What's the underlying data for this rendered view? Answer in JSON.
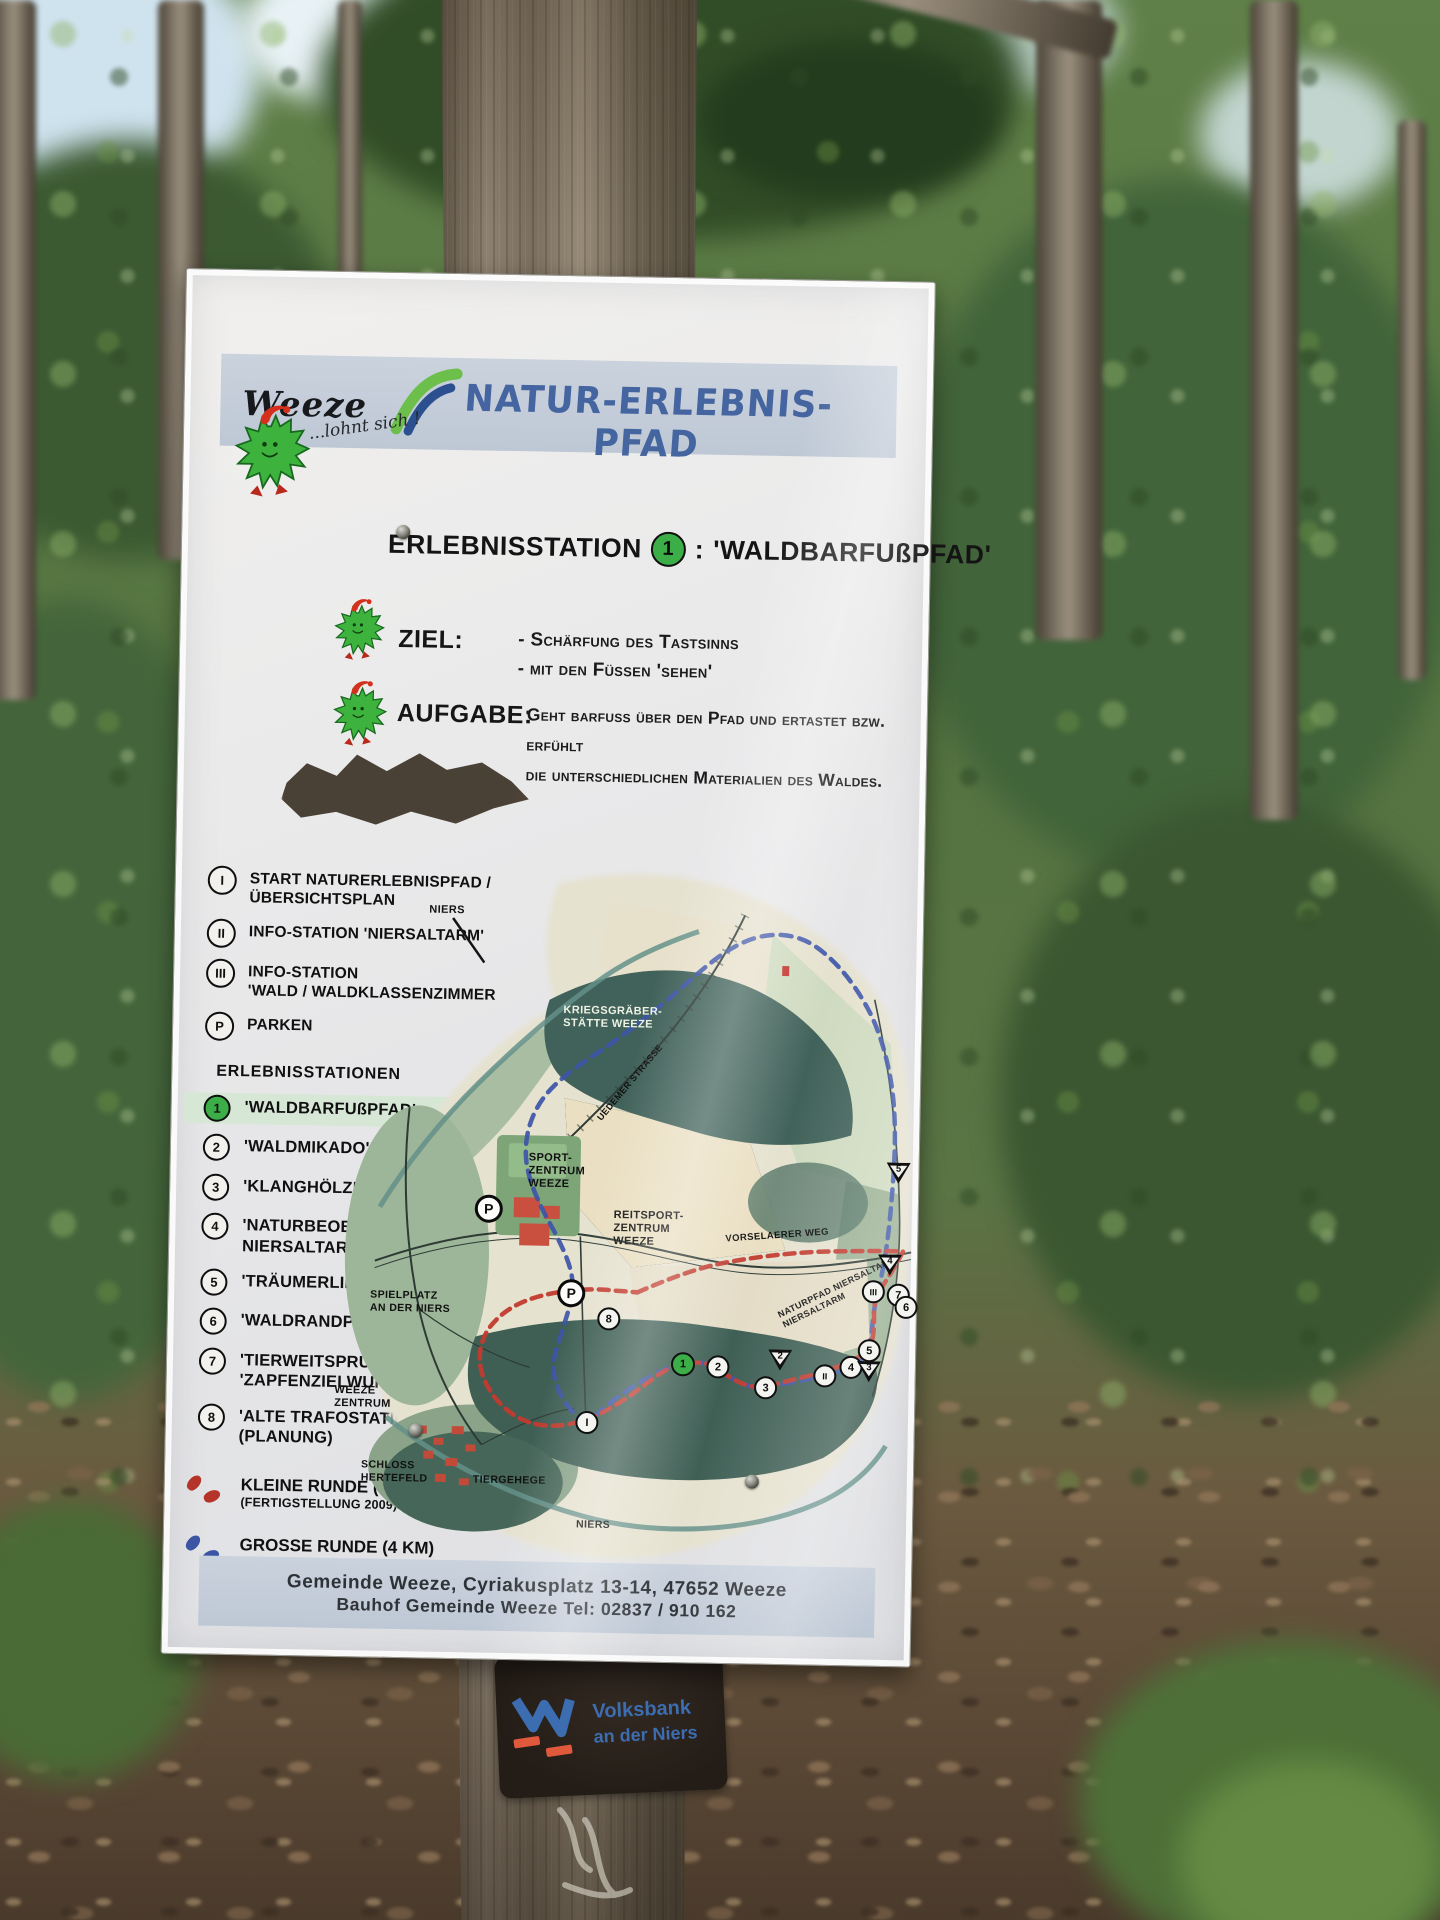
{
  "header": {
    "logo_text": "Weeze",
    "logo_tagline": "...lohnt sich !",
    "title": "NATUR-ERLEBNIS-PFAD"
  },
  "heading": {
    "prefix": "ERLEBNISSTATION",
    "number": "1",
    "separator": ":",
    "name": "'WALDBARFUßPFAD'"
  },
  "ziel": {
    "label": "ZIEL:",
    "lines_text": "- Schärfung des Tastsinns\n- mit den Füssen 'sehen'"
  },
  "aufgabe": {
    "label": "AUFGABE:",
    "lines_text": "Geht barfuss über den Pfad und ertastet bzw. erfühlt\ndie unterschiedlichen Materialien des Waldes."
  },
  "legend": {
    "items": [
      {
        "sym": "I",
        "lines": [
          "START NATURERLEBNISPFAD / ÜBERSICHTSPLAN"
        ]
      },
      {
        "sym": "II",
        "lines": [
          "INFO-STATION 'NIERSALTARM'"
        ]
      },
      {
        "sym": "III",
        "lines": [
          "INFO-STATION",
          "'WALD / WALDKLASSENZIMMER"
        ]
      },
      {
        "sym": "P",
        "lines": [
          "PARKEN"
        ]
      }
    ],
    "stations_title": "ERLEBNISSTATIONEN",
    "stations": [
      {
        "num": "1",
        "lines": [
          "'WALDBARFUßPFAD'"
        ],
        "highlight": true
      },
      {
        "num": "2",
        "lines": [
          "'WALDMIKADO'"
        ]
      },
      {
        "num": "3",
        "lines": [
          "'KLANGHÖLZER'"
        ]
      },
      {
        "num": "4",
        "lines": [
          "'NATURBEOBACHTUNG",
          "NIERSALTARM'"
        ]
      },
      {
        "num": "5",
        "lines": [
          "'TRÄUMERLIEGEN'"
        ]
      },
      {
        "num": "6",
        "lines": [
          "'WALDRANDPARCOURS'"
        ]
      },
      {
        "num": "7",
        "lines": [
          "'TIERWEITSPRUNG' UND",
          "'ZAPFENZIELWURF'"
        ]
      },
      {
        "num": "8",
        "lines": [
          "'ALTE TRAFOSTATION'",
          "(PLANUNG)"
        ]
      }
    ],
    "routes": [
      {
        "label": "KLEINE RUNDE (2 KM)",
        "sub": "(FERTIGSTELLUNG 2009)",
        "color": "#b5342a"
      },
      {
        "label": "GROSSE RUNDE (4 KM)",
        "sub": "(GEPLANT)",
        "color": "#3b55a4"
      }
    ]
  },
  "map": {
    "labels": [
      {
        "text": "NIERS",
        "x": 96,
        "y": 38,
        "rot": 0,
        "color": "#141414",
        "size": 11
      },
      {
        "text": "KRIEGSGRÄBER-\nSTÄTTE WEEZE",
        "x": 232,
        "y": 136,
        "rot": 0,
        "color": "#eef2e4",
        "size": 11
      },
      {
        "text": "SPORT-\nZENTRUM\nWEEZE",
        "x": 200,
        "y": 284,
        "rot": 0,
        "color": "#101010",
        "size": 11
      },
      {
        "text": "REITSPORT-\nZENTRUM\nWEEZE",
        "x": 286,
        "y": 340,
        "rot": 0,
        "color": "#101010",
        "size": 11
      },
      {
        "text": "SPIELPLATZ\nAN DER NIERS",
        "x": 44,
        "y": 424,
        "rot": 0,
        "color": "#101010",
        "size": 10.5
      },
      {
        "text": "WEEZE\nZENTRUM",
        "x": 10,
        "y": 520,
        "rot": 0,
        "color": "#101010",
        "size": 11
      },
      {
        "text": "SCHLOSS\nHERTEFELD",
        "x": 38,
        "y": 594,
        "rot": 0,
        "color": "#101010",
        "size": 10.5
      },
      {
        "text": "TIERGEHEGE",
        "x": 150,
        "y": 607,
        "rot": 0,
        "color": "#101010",
        "size": 10.5
      },
      {
        "text": "NIERS",
        "x": 254,
        "y": 650,
        "rot": 0,
        "color": "#101010",
        "size": 10.5
      },
      {
        "text": "VORSELAERER WEG",
        "x": 398,
        "y": 358,
        "rot": -5,
        "color": "#101010",
        "size": 9.5
      },
      {
        "text": "UEDEMER STRASSE",
        "x": 252,
        "y": 208,
        "rot": -51,
        "color": "#101010",
        "size": 9
      },
      {
        "text": "NATURPFAD NIERSALTARM\nNIERSALTARM",
        "x": 448,
        "y": 408,
        "rot": -27,
        "color": "#101010",
        "size": 9
      }
    ],
    "markers": [
      {
        "t": "p",
        "n": "P",
        "x": 161,
        "y": 342
      },
      {
        "t": "p",
        "n": "P",
        "x": 245,
        "y": 425
      },
      {
        "t": "c",
        "n": "8",
        "x": 283,
        "y": 450
      },
      {
        "t": "c",
        "n": "I",
        "x": 263,
        "y": 554
      },
      {
        "t": "g",
        "n": "1",
        "x": 358,
        "y": 494
      },
      {
        "t": "c",
        "n": "2",
        "x": 393,
        "y": 496
      },
      {
        "t": "c",
        "n": "3",
        "x": 441,
        "y": 516
      },
      {
        "t": "t",
        "n": "2",
        "x": 455,
        "y": 488
      },
      {
        "t": "c",
        "n": "II",
        "x": 500,
        "y": 503
      },
      {
        "t": "c",
        "n": "4",
        "x": 526,
        "y": 494
      },
      {
        "t": "t",
        "n": "3",
        "x": 544,
        "y": 498
      },
      {
        "t": "c",
        "n": "5",
        "x": 544,
        "y": 477
      },
      {
        "t": "c",
        "n": "III",
        "x": 547,
        "y": 418
      },
      {
        "t": "c",
        "n": "7",
        "x": 572,
        "y": 421
      },
      {
        "t": "c",
        "n": "6",
        "x": 580,
        "y": 433
      },
      {
        "t": "t",
        "n": "4",
        "x": 563,
        "y": 391
      },
      {
        "t": "t",
        "n": "5",
        "x": 570,
        "y": 299
      }
    ]
  },
  "footer": {
    "line1": "Gemeinde Weeze, Cyriakusplatz 13-14, 47652 Weeze",
    "line2": "Bauhof Gemeinde Weeze   Tel: 02837 / 910 162"
  },
  "sticker": {
    "brand": "Volksbank",
    "brand_sub": "an der Niers"
  }
}
